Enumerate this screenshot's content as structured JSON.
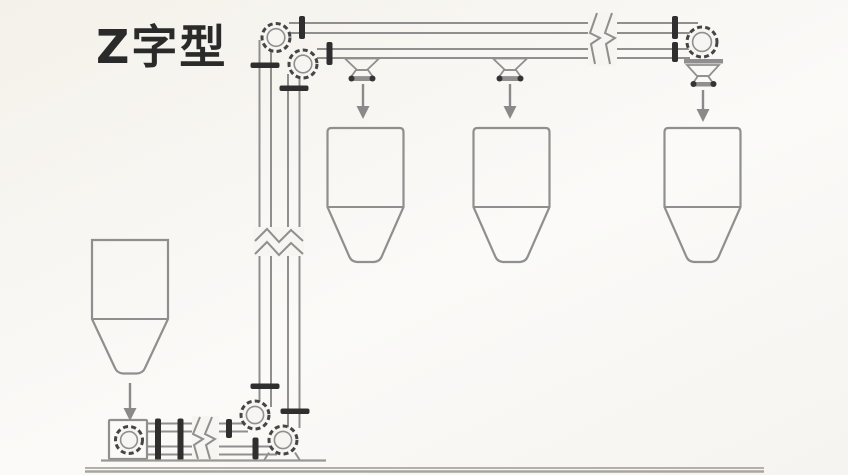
{
  "header": {
    "title": "Z字型"
  },
  "colors": {
    "background": "#f7f5f2",
    "line": "#8f8f8f",
    "dark_flange": "#2f2f2f",
    "wheel_rim": "#454545",
    "arrow": "#8a8a8a",
    "ground": "#aeaba5",
    "title_text": "#2a2a2a"
  },
  "diagram": {
    "type": "z-type-conveyor-schematic",
    "canvas": {
      "width": 848,
      "height": 475
    },
    "elements": [
      {
        "k": "line",
        "n": "track-top-upper-line1",
        "x1": 289,
        "y1": 23,
        "x2": 698,
        "y2": 23
      },
      {
        "k": "line",
        "n": "track-top-upper-line2",
        "x1": 289,
        "y1": 33,
        "x2": 691,
        "y2": 33
      },
      {
        "k": "line",
        "n": "track-top-lower-line1",
        "x1": 317,
        "y1": 49,
        "x2": 694,
        "y2": 49
      },
      {
        "k": "line",
        "n": "track-top-lower-line2",
        "x1": 317,
        "y1": 58,
        "x2": 690,
        "y2": 58
      },
      {
        "k": "line",
        "n": "track-vertical-left-line1",
        "x1": 259.5,
        "y1": 40,
        "x2": 259.5,
        "y2": 407
      },
      {
        "k": "line",
        "n": "track-vertical-left-line2",
        "x1": 271,
        "y1": 49,
        "x2": 271,
        "y2": 407
      },
      {
        "k": "line",
        "n": "track-vertical-right-line1",
        "x1": 288,
        "y1": 74,
        "x2": 288,
        "y2": 436
      },
      {
        "k": "line",
        "n": "track-vertical-right-line2",
        "x1": 299.5,
        "y1": 74,
        "x2": 299.5,
        "y2": 428
      },
      {
        "k": "line",
        "n": "track-bottom-upper-line1",
        "x1": 147,
        "y1": 423.5,
        "x2": 248,
        "y2": 423.5
      },
      {
        "k": "line",
        "n": "track-bottom-upper-line2",
        "x1": 147,
        "y1": 431.5,
        "x2": 248,
        "y2": 431.5
      },
      {
        "k": "line",
        "n": "track-bottom-lower-line1",
        "x1": 147,
        "y1": 446.5,
        "x2": 277,
        "y2": 446.5
      },
      {
        "k": "line",
        "n": "track-bottom-lower-line2",
        "x1": 147,
        "y1": 454.5,
        "x2": 277,
        "y2": 454.5
      },
      {
        "k": "rect",
        "n": "break-mask-top",
        "x": 588,
        "y": 12,
        "wd": 29,
        "ht": 54,
        "f": "#f7f5f2",
        "s": "none"
      },
      {
        "k": "polyline",
        "n": "break-zigzag-top-1",
        "p": "597,13 590,33 600,38 591,44 595,64"
      },
      {
        "k": "polyline",
        "n": "break-zigzag-top-2",
        "p": "612,13 605,33 615,38 606,44 610,64"
      },
      {
        "k": "rect",
        "n": "break-mask-vertical",
        "x": 253,
        "y": 227,
        "wd": 51,
        "ht": 29,
        "f": "#f7f5f2",
        "s": "none"
      },
      {
        "k": "polyline",
        "n": "break-zigzag-vertical-1",
        "p": "255,241 267,229 279,242 291,230 303,241"
      },
      {
        "k": "polyline",
        "n": "break-zigzag-vertical-2",
        "p": "255,254 267,242 279,255 291,243 303,254"
      },
      {
        "k": "rect",
        "n": "break-mask-bottom",
        "x": 192,
        "y": 416,
        "wd": 27,
        "ht": 44,
        "f": "#f7f5f2",
        "s": "none"
      },
      {
        "k": "polyline",
        "n": "break-zigzag-bottom-1",
        "p": "200,417 193,434 203,439 194,445 198,459"
      },
      {
        "k": "polyline",
        "n": "break-zigzag-bottom-2",
        "p": "212,417 205,434 215,439 206,445 210,459"
      },
      {
        "k": "polygon",
        "n": "discharge-hopper-1-funnel",
        "p": "345,58.5 379,58.5 367,70 357,70",
        "w": 1.8
      },
      {
        "k": "polygon",
        "n": "discharge-hopper-1-valve",
        "p": "356,70 368,70 373,77 351,77",
        "w": 1.8
      },
      {
        "k": "rect",
        "n": "discharge-hopper-1-valve-bar",
        "x": 349,
        "y": 76.5,
        "wd": 26,
        "ht": 4.5,
        "rx": 2,
        "f": "#8f8f8f",
        "s": "none"
      },
      {
        "k": "circle",
        "n": "discharge-hopper-1-valve-cap-left",
        "cx": 351.5,
        "cy": 78.5,
        "r": 3,
        "f": "#343434",
        "s": "none"
      },
      {
        "k": "circle",
        "n": "discharge-hopper-1-valve-cap-right",
        "cx": 372.5,
        "cy": 78.5,
        "r": 3,
        "f": "#343434",
        "s": "none"
      },
      {
        "k": "polygon",
        "n": "discharge-hopper-2-funnel",
        "p": "493,58.5 527,58.5 515,70 505,70",
        "w": 1.8
      },
      {
        "k": "polygon",
        "n": "discharge-hopper-2-valve",
        "p": "504,70 516,70 521,77 499,77",
        "w": 1.8
      },
      {
        "k": "rect",
        "n": "discharge-hopper-2-valve-bar",
        "x": 497,
        "y": 76.5,
        "wd": 26,
        "ht": 4.5,
        "rx": 2,
        "f": "#8f8f8f",
        "s": "none"
      },
      {
        "k": "circle",
        "n": "discharge-hopper-2-valve-cap-left",
        "cx": 499.5,
        "cy": 78.5,
        "r": 3,
        "f": "#343434",
        "s": "none"
      },
      {
        "k": "circle",
        "n": "discharge-hopper-2-valve-cap-right",
        "cx": 520.5,
        "cy": 78.5,
        "r": 3,
        "f": "#343434",
        "s": "none"
      },
      {
        "k": "rect",
        "n": "discharge-head-bar",
        "x": 684,
        "y": 59,
        "wd": 39,
        "ht": 4.5,
        "f": "#8f8f8f",
        "s": "none"
      },
      {
        "k": "polygon",
        "n": "discharge-head-funnel",
        "p": "687,65 719,65 709,76 697,76",
        "w": 1.8
      },
      {
        "k": "polygon",
        "n": "discharge-head-valve",
        "p": "698,76 708,76 713,83 693,83",
        "w": 1.8
      },
      {
        "k": "rect",
        "n": "discharge-head-valve-bar",
        "x": 691,
        "y": 82,
        "wd": 25,
        "ht": 4.5,
        "rx": 2,
        "f": "#8f8f8f",
        "s": "none"
      },
      {
        "k": "circle",
        "n": "discharge-head-valve-cap-left",
        "cx": 693.5,
        "cy": 84,
        "r": 3,
        "f": "#343434",
        "s": "none"
      },
      {
        "k": "circle",
        "n": "discharge-head-valve-cap-right",
        "cx": 713.5,
        "cy": 84,
        "r": 3,
        "f": "#343434",
        "s": "none"
      },
      {
        "k": "path",
        "n": "silo-1-body",
        "d": "M 327.5 132 Q 327.5 128 331.5 128 L 399.5 128 Q 403.5 128 403.5 132 L 403.5 207 L 381.5 257 Q 379.5 261.5 374 262 L 357 262 Q 351.5 261.5 349.5 257 L 327.5 207 Z",
        "w": 2.2
      },
      {
        "k": "line",
        "n": "silo-1-divider",
        "x1": 327.5,
        "y1": 207,
        "x2": 403.5,
        "y2": 207
      },
      {
        "k": "path",
        "n": "silo-2-body",
        "d": "M 473.5 132 Q 473.5 128 477.5 128 L 545.5 128 Q 549.5 128 549.5 132 L 549.5 207 L 527.5 257 Q 525.5 261.5 520 262 L 503 262 Q 497.5 261.5 495.5 257 L 473.5 207 Z",
        "w": 2.2
      },
      {
        "k": "line",
        "n": "silo-2-divider",
        "x1": 473.5,
        "y1": 207,
        "x2": 549.5,
        "y2": 207
      },
      {
        "k": "path",
        "n": "silo-3-body",
        "d": "M 664.5 132 Q 664.5 128 668.5 128 L 736.5 128 Q 740.5 128 740.5 132 L 740.5 207 L 718.5 257 Q 716.5 261.5 711 262 L 694 262 Q 688.5 261.5 686.5 257 L 664.5 207 Z",
        "w": 2.2
      },
      {
        "k": "line",
        "n": "silo-3-divider",
        "x1": 664.5,
        "y1": 207,
        "x2": 740.5,
        "y2": 207
      },
      {
        "k": "path",
        "n": "feed-hopper-body",
        "d": "M 92 240 L 168 240 L 168 319 L 145 368 Q 143 373 137 373.5 L 123 373.5 Q 117 373 115 368 L 92 319 Z",
        "w": 2.2
      },
      {
        "k": "line",
        "n": "feed-hopper-divider",
        "x1": 92,
        "y1": 319,
        "x2": 168,
        "y2": 319
      },
      {
        "k": "rect",
        "n": "feed-wheel-housing",
        "x": 109,
        "y": 420,
        "wd": 38,
        "ht": 39,
        "rx": 1,
        "w": 2.2
      },
      {
        "k": "circle",
        "n": "wheel-top-left-outer",
        "cx": 276,
        "cy": 37.5,
        "r": 14,
        "f": "#f7f5f2",
        "s": "#454545",
        "w": 3,
        "dash": "5 3.2"
      },
      {
        "k": "circle",
        "n": "wheel-top-left-inner",
        "cx": 276,
        "cy": 37.5,
        "r": 8.8,
        "w": 1.6
      },
      {
        "k": "circle",
        "n": "wheel-top-left2-outer",
        "cx": 303,
        "cy": 64,
        "r": 14,
        "f": "#f7f5f2",
        "s": "#454545",
        "w": 3,
        "dash": "5 3.2"
      },
      {
        "k": "circle",
        "n": "wheel-top-left2-inner",
        "cx": 303,
        "cy": 64,
        "r": 8.8,
        "w": 1.6
      },
      {
        "k": "circle",
        "n": "wheel-bottom-upper-outer",
        "cx": 255,
        "cy": 415,
        "r": 14,
        "f": "#f7f5f2",
        "s": "#454545",
        "w": 3,
        "dash": "5 3.2"
      },
      {
        "k": "circle",
        "n": "wheel-bottom-upper-inner",
        "cx": 255,
        "cy": 415,
        "r": 8.6,
        "w": 1.6
      },
      {
        "k": "circle",
        "n": "wheel-bottom-lower-outer",
        "cx": 283,
        "cy": 440,
        "r": 14,
        "f": "#f7f5f2",
        "s": "#454545",
        "w": 3,
        "dash": "5 3.2"
      },
      {
        "k": "circle",
        "n": "wheel-bottom-lower-inner",
        "cx": 283,
        "cy": 440,
        "r": 8.6,
        "w": 1.6
      },
      {
        "k": "circle",
        "n": "feed-wheel-outer",
        "cx": 129,
        "cy": 440,
        "r": 13.5,
        "f": "#f7f5f2",
        "s": "#454545",
        "w": 3,
        "dash": "5 3.2"
      },
      {
        "k": "circle",
        "n": "feed-wheel-inner",
        "cx": 129,
        "cy": 440,
        "r": 8.4,
        "w": 1.6
      },
      {
        "k": "circle",
        "n": "wheel-top-right-outer",
        "cx": 702,
        "cy": 42,
        "r": 15,
        "f": "#f7f5f2",
        "s": "#454545",
        "w": 3,
        "dash": "5 3.2"
      },
      {
        "k": "circle",
        "n": "wheel-top-right-inner",
        "cx": 702,
        "cy": 42,
        "r": 9.4,
        "w": 1.6
      },
      {
        "k": "line",
        "n": "wheel-support-left",
        "x1": 269,
        "y1": 452.5,
        "x2": 264,
        "y2": 460.5
      },
      {
        "k": "line",
        "n": "wheel-support-right",
        "x1": 295,
        "y1": 452.5,
        "x2": 300,
        "y2": 460.5
      },
      {
        "k": "rect",
        "n": "flange-top-run-1",
        "x": 299,
        "y": 16,
        "wd": 6,
        "ht": 23,
        "rx": 2,
        "f": "#2f2f2f",
        "s": "none"
      },
      {
        "k": "rect",
        "n": "flange-top-run-2",
        "x": 326.5,
        "y": 42,
        "wd": 6,
        "ht": 23,
        "rx": 2,
        "f": "#2f2f2f",
        "s": "none"
      },
      {
        "k": "rect",
        "n": "flange-top-right-1",
        "x": 672,
        "y": 16,
        "wd": 6,
        "ht": 23,
        "rx": 2,
        "f": "#2f2f2f",
        "s": "none"
      },
      {
        "k": "rect",
        "n": "flange-top-right-2",
        "x": 672,
        "y": 42,
        "wd": 6,
        "ht": 20,
        "rx": 2,
        "f": "#2f2f2f",
        "s": "none"
      },
      {
        "k": "rect",
        "n": "flange-vertical-left-top",
        "x": 250.5,
        "y": 62.5,
        "wd": 29,
        "ht": 5.5,
        "rx": 2,
        "f": "#2f2f2f",
        "s": "none"
      },
      {
        "k": "rect",
        "n": "flange-vertical-right-top",
        "x": 279.5,
        "y": 85.5,
        "wd": 29,
        "ht": 5.5,
        "rx": 2,
        "f": "#2f2f2f",
        "s": "none"
      },
      {
        "k": "rect",
        "n": "flange-vertical-left-bottom",
        "x": 250.5,
        "y": 383.5,
        "wd": 29,
        "ht": 5.5,
        "rx": 2,
        "f": "#2f2f2f",
        "s": "none"
      },
      {
        "k": "rect",
        "n": "flange-vertical-right-bottom",
        "x": 280.5,
        "y": 408.5,
        "wd": 29,
        "ht": 5.5,
        "rx": 2,
        "f": "#2f2f2f",
        "s": "none"
      },
      {
        "k": "rect",
        "n": "flange-bottom-run-1",
        "x": 155,
        "y": 418.5,
        "wd": 6,
        "ht": 42,
        "rx": 2,
        "f": "#2f2f2f",
        "s": "none"
      },
      {
        "k": "rect",
        "n": "flange-bottom-run-2",
        "x": 177.5,
        "y": 418.5,
        "wd": 6,
        "ht": 42,
        "rx": 2,
        "f": "#2f2f2f",
        "s": "none"
      },
      {
        "k": "rect",
        "n": "flange-bottom-run-3",
        "x": 226,
        "y": 419,
        "wd": 6,
        "ht": 19,
        "rx": 2,
        "f": "#2f2f2f",
        "s": "none"
      },
      {
        "k": "rect",
        "n": "flange-bottom-run-4",
        "x": 252.5,
        "y": 437.5,
        "wd": 6,
        "ht": 22,
        "rx": 2,
        "f": "#2f2f2f",
        "s": "none"
      },
      {
        "k": "line",
        "n": "feed-arrow-shaft",
        "x1": 130,
        "y1": 383,
        "x2": 130,
        "y2": 410,
        "s": "#8a8a8a",
        "w": 2.4
      },
      {
        "k": "polygon",
        "n": "feed-arrow-head",
        "p": "123.5,408 136.5,408 130,421",
        "f": "#8a8a8a",
        "s": "none"
      },
      {
        "k": "line",
        "n": "flow-arrow-1-shaft",
        "x1": 363,
        "y1": 84,
        "x2": 363,
        "y2": 108,
        "s": "#8a8a8a",
        "w": 2.4
      },
      {
        "k": "polygon",
        "n": "flow-arrow-1-head",
        "p": "356.5,106 369.5,106 363,119",
        "f": "#8a8a8a",
        "s": "none"
      },
      {
        "k": "line",
        "n": "flow-arrow-2-shaft",
        "x1": 510,
        "y1": 84,
        "x2": 510,
        "y2": 108,
        "s": "#8a8a8a",
        "w": 2.4
      },
      {
        "k": "polygon",
        "n": "flow-arrow-2-head",
        "p": "503.5,106 516.5,106 510,119",
        "f": "#8a8a8a",
        "s": "none"
      },
      {
        "k": "line",
        "n": "flow-arrow-3-shaft",
        "x1": 703,
        "y1": 90,
        "x2": 703,
        "y2": 111,
        "s": "#8a8a8a",
        "w": 2.4
      },
      {
        "k": "polygon",
        "n": "flow-arrow-3-head",
        "p": "696.5,109 709.5,109 703,122",
        "f": "#8a8a8a",
        "s": "none"
      },
      {
        "k": "line",
        "n": "assembly-base-line",
        "x1": 101,
        "y1": 460.5,
        "x2": 326,
        "y2": 460.5,
        "s": "#9b9894",
        "w": 2.2
      },
      {
        "k": "line",
        "n": "ground-line-upper",
        "x1": 85,
        "y1": 468,
        "x2": 764,
        "y2": 468,
        "s": "#b3b0aa",
        "w": 2
      },
      {
        "k": "line",
        "n": "ground-line-lower",
        "x1": 85,
        "y1": 471.5,
        "x2": 764,
        "y2": 471.5,
        "s": "#a8a5a0",
        "w": 2.5
      }
    ]
  }
}
